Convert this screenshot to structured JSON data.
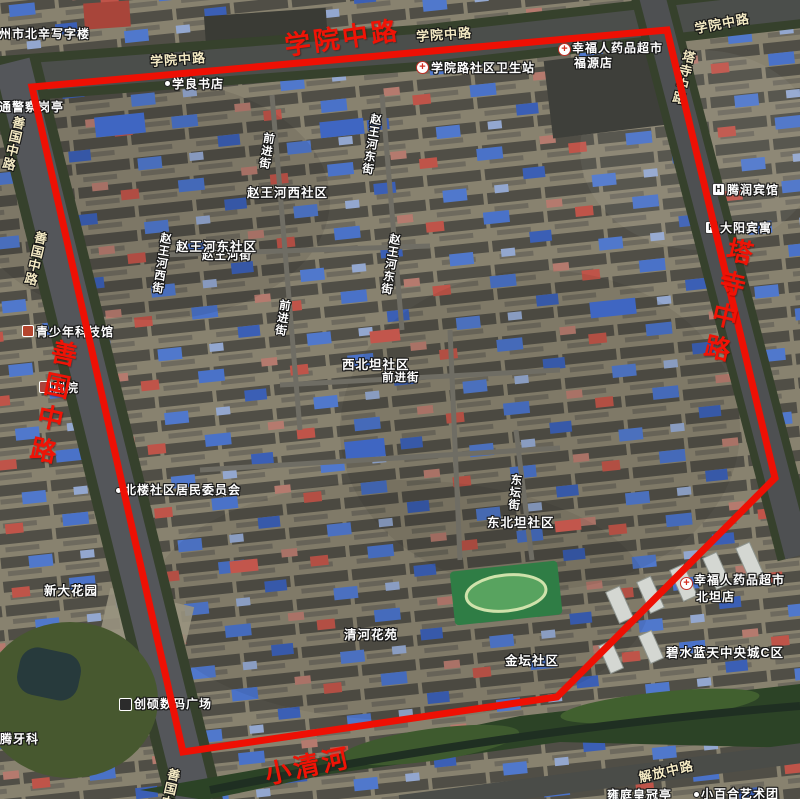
{
  "map_labels": {
    "red": [
      {
        "text": "学院中路"
      },
      {
        "text": "善国中路"
      },
      {
        "text": "塔寺中路"
      },
      {
        "text": "小清河"
      }
    ],
    "roads": [
      {
        "text": "学院中路"
      },
      {
        "text": "学院中路"
      },
      {
        "text": "学院中路"
      },
      {
        "text": "善国中路"
      },
      {
        "text": "善国中路"
      },
      {
        "text": "塔寺中路"
      },
      {
        "text": "解放中路"
      },
      {
        "text": "善国中路"
      }
    ],
    "streets": [
      {
        "text": "前进街"
      },
      {
        "text": "赵王河东街"
      },
      {
        "text": "赵王河西街"
      },
      {
        "text": "赵王河东街"
      },
      {
        "text": "赵王河街"
      },
      {
        "text": "前进街"
      },
      {
        "text": "前进街"
      },
      {
        "text": "东坛街"
      }
    ],
    "communities": [
      {
        "text": "赵王河西社区"
      },
      {
        "text": "赵王河东社区"
      },
      {
        "text": "西北坦社区"
      },
      {
        "text": "东北坦社区"
      },
      {
        "text": "清河花苑"
      },
      {
        "text": "金坛社区"
      },
      {
        "text": "新大花园"
      },
      {
        "text": "碧水蓝天中央城C区"
      }
    ],
    "pois": [
      {
        "text": "滕州市北辛写字楼"
      },
      {
        "text": "学良书店"
      },
      {
        "text": "学院路社区卫生站"
      },
      {
        "text": "幸福人药品超市"
      },
      {
        "text": "福源店"
      },
      {
        "text": "交通警察岗亭"
      },
      {
        "text": "腾润宾馆"
      },
      {
        "text": "大阳宾寓"
      },
      {
        "text": "青少年科技馆"
      },
      {
        "text": "剧院"
      },
      {
        "text": "北楼社区居民委员会"
      },
      {
        "text": "创硕数码广场"
      },
      {
        "text": "幸福人药品超市"
      },
      {
        "text": "北坦店"
      },
      {
        "text": "腾牙科"
      },
      {
        "text": "雍庭皇冠亭"
      },
      {
        "text": "小百合艺术团"
      }
    ]
  },
  "boundary": {
    "points": "32,87 667,30 775,478 557,697 183,752",
    "stroke_color": "#ee1004"
  },
  "colors": {
    "red_label": "#f01306",
    "road_label": "#f3e9c3",
    "poi_label": "#ffffff",
    "blue_roof": "#4a72c8"
  }
}
